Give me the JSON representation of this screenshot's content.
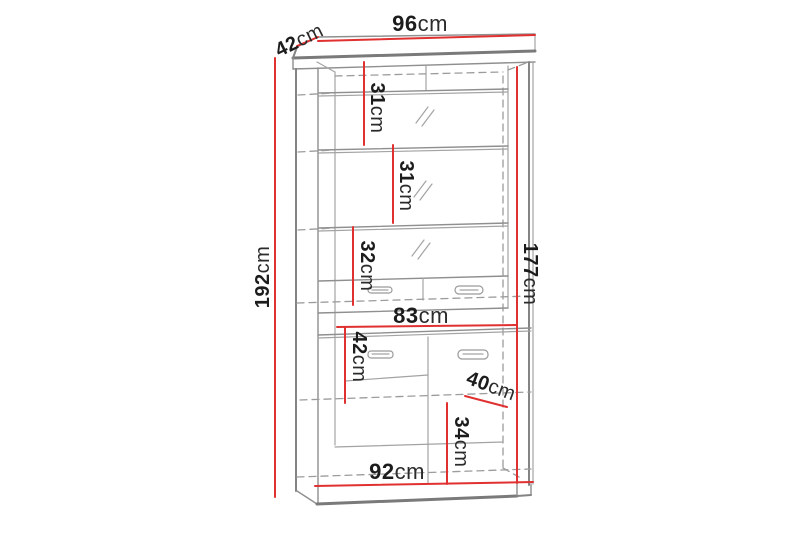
{
  "diagram": {
    "name": "cabinet-dimension-drawing",
    "unit": "cm",
    "colors": {
      "dimension_line_red": "#e03030",
      "cabinet_outline_gray": "#8f8f8f",
      "text_black": "#1c1c1c",
      "background": "#ffffff"
    },
    "dimensions": {
      "top_width": {
        "value": "96",
        "unit": "cm"
      },
      "top_depth": {
        "value": "42",
        "unit": "cm"
      },
      "shelf_gap_1": {
        "value": "31",
        "unit": "cm"
      },
      "shelf_gap_2": {
        "value": "31",
        "unit": "cm"
      },
      "shelf_gap_3": {
        "value": "32",
        "unit": "cm"
      },
      "total_height": {
        "value": "192",
        "unit": "cm"
      },
      "interior_height": {
        "value": "177",
        "unit": "cm"
      },
      "interior_width": {
        "value": "83",
        "unit": "cm"
      },
      "door_upper_height": {
        "value": "42",
        "unit": "cm"
      },
      "lower_depth": {
        "value": "40",
        "unit": "cm"
      },
      "door_lower_height": {
        "value": "34",
        "unit": "cm"
      },
      "base_width": {
        "value": "92",
        "unit": "cm"
      }
    }
  }
}
